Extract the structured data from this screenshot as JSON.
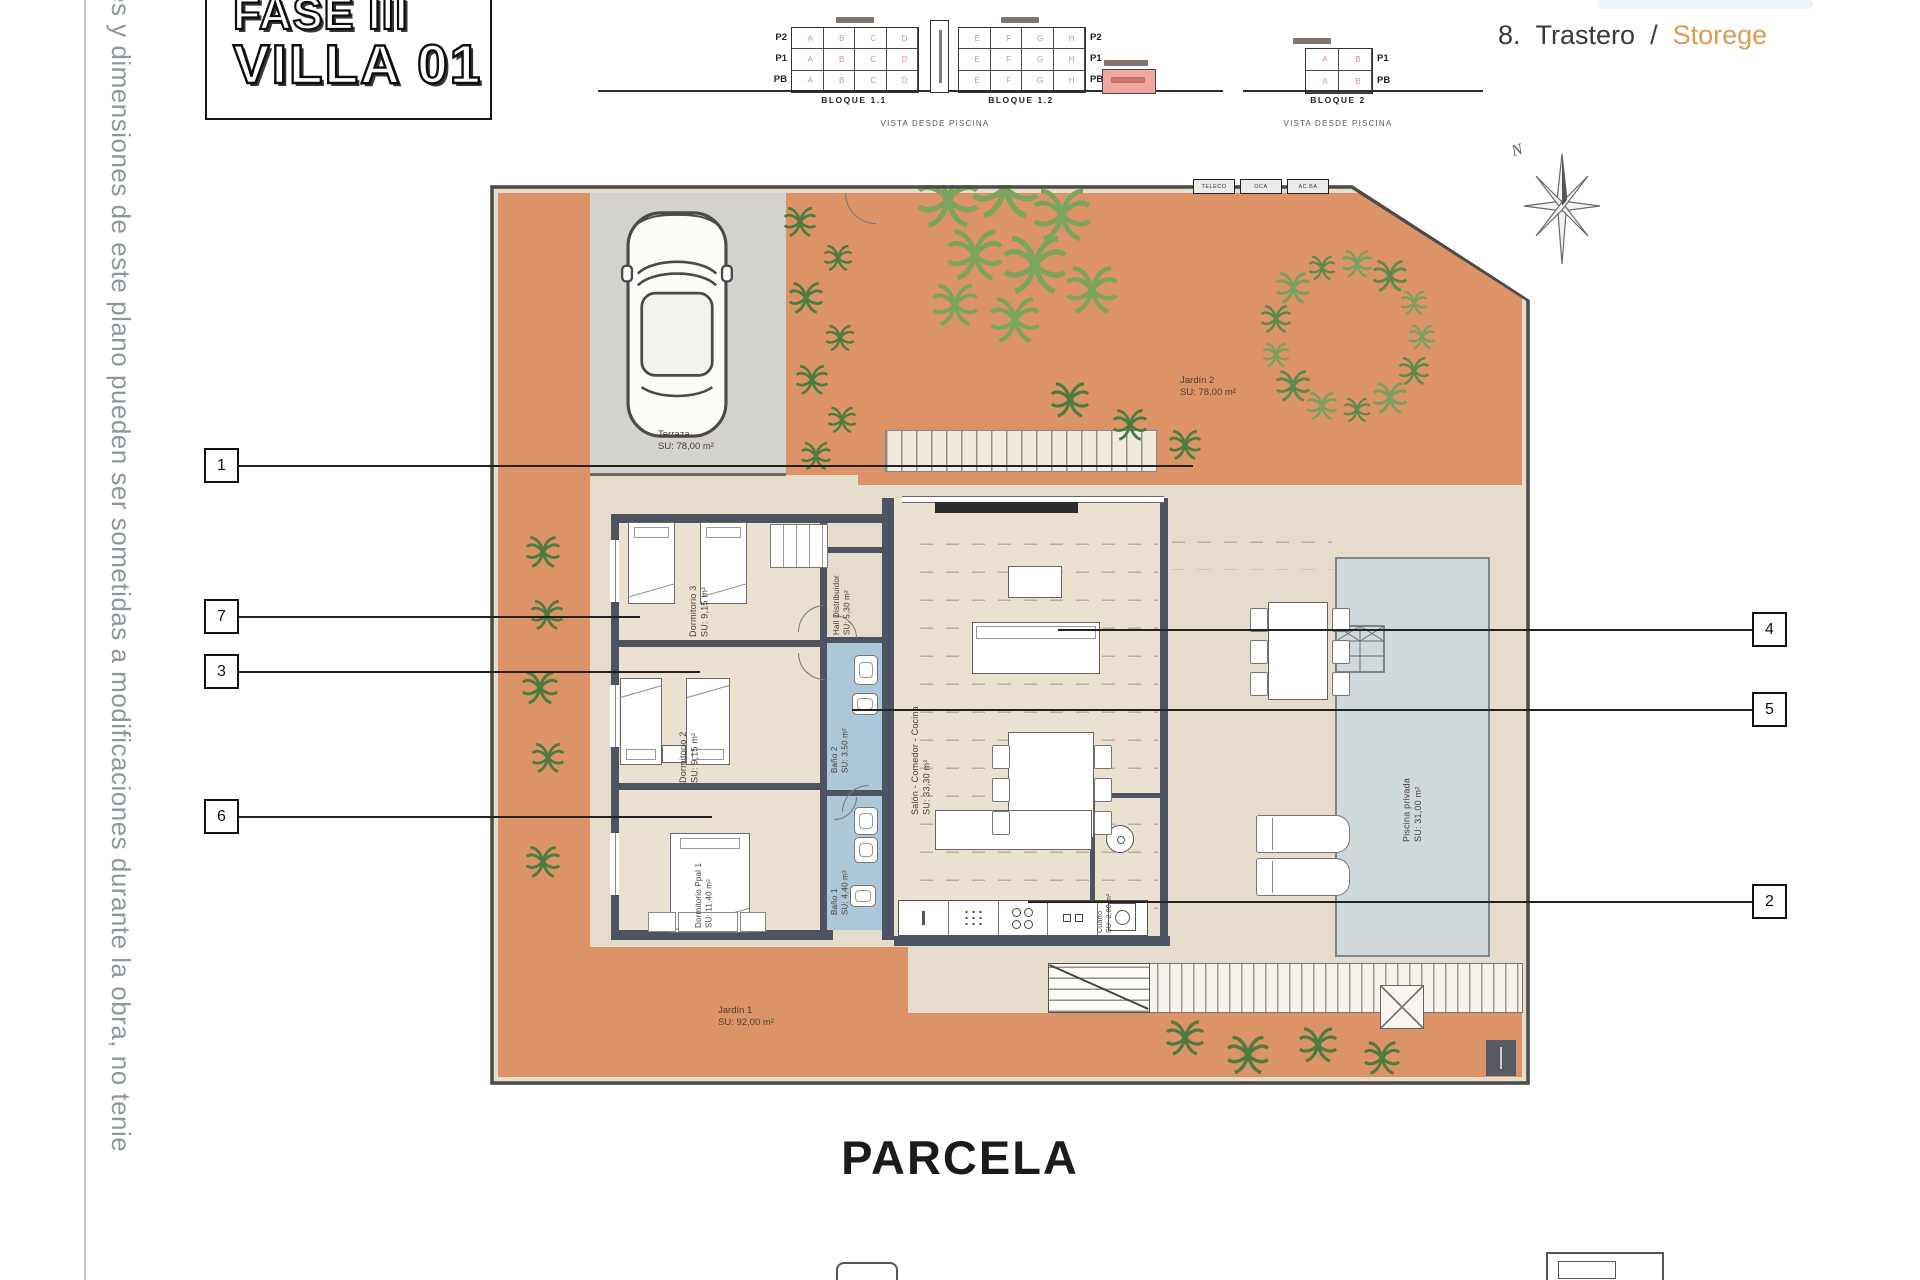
{
  "page": {
    "side_note": "es y dimensiones de este plano pueden ser sometidas a modificaciones durante la obra, no tenie",
    "parcela_label": "PARCELA",
    "north_label": "N"
  },
  "title_block": {
    "line1": "FASE III",
    "line2": "VILLA 01"
  },
  "legend": {
    "number": "8.",
    "label_es": "Trastero",
    "separator": "/",
    "label_en": "Storege"
  },
  "elevations": {
    "vista_caption_left": "VISTA DESDE PISCINA",
    "vista_caption_right": "VISTA DESDE PISCINA",
    "bloques": [
      {
        "name": "BLOQUE 1.1",
        "floors": [
          "P2",
          "P1",
          "PB"
        ],
        "units": [
          "A",
          "B",
          "C",
          "D"
        ]
      },
      {
        "name": "BLOQUE 1.2",
        "floors": [
          "P2",
          "P1",
          "PB"
        ],
        "units": [
          "E",
          "F",
          "G",
          "H"
        ]
      },
      {
        "name": "BLOQUE 2",
        "floors": [
          "P1",
          "PB"
        ],
        "units": [
          "A",
          "B"
        ]
      }
    ]
  },
  "plan": {
    "rooms": {
      "terraza": {
        "name": "Terraza",
        "area": "SU: 78,00 m²"
      },
      "jardin2": {
        "name": "Jardín 2",
        "area": "SU: 78,00 m²"
      },
      "jardin1": {
        "name": "Jardín 1",
        "area": "SU: 92,00 m²"
      },
      "piscina": {
        "name": "Piscina privada",
        "area": "SU: 31,00 m²"
      },
      "dormitorio3": {
        "name": "Dormitorio 3",
        "area": "SU: 9,15 m²"
      },
      "dormitorio2": {
        "name": "Dormitorio 2",
        "area": "SU: 9,15 m²"
      },
      "dormitorio_ppal": {
        "name": "Dormitorio Ppal 1",
        "area": "SU: 11,40 m²"
      },
      "hall": {
        "name": "Hall Distribuidor",
        "area": "SU: 5,30 m²"
      },
      "bano2": {
        "name": "Baño 2",
        "area": "SU: 3,50 m²"
      },
      "bano1": {
        "name": "Baño 1",
        "area": "SU: 4,40 m²"
      },
      "salon": {
        "name": "Salón - Comedor - Cocina",
        "area": "SU: 33,30 m²"
      },
      "cuarto": {
        "name": "Cuarto",
        "area": "SU: 2,00 m²"
      }
    },
    "utility_meters": [
      "TELECO",
      "OCA",
      "AC.BA"
    ],
    "callouts": {
      "c1": "1",
      "c7": "7",
      "c3": "3",
      "c6": "6",
      "c4": "4",
      "c5": "5",
      "c2": "2"
    }
  },
  "icons": {
    "palm_tree": "radial-frond-asterisk",
    "fern": "radial-frond-asterisk",
    "north_compass": "eight-point-star",
    "car": "top-view-car"
  },
  "colors": {
    "terrain_orange": "#dd9368",
    "terrace_beige": "#e6dccb",
    "pool_blue": "#cfd8db",
    "bath_blue": "#abc7d8",
    "wall_dark": "#4d5360",
    "highlight_pink": "#f0a79e",
    "legend_orange": "#dd9a52"
  }
}
